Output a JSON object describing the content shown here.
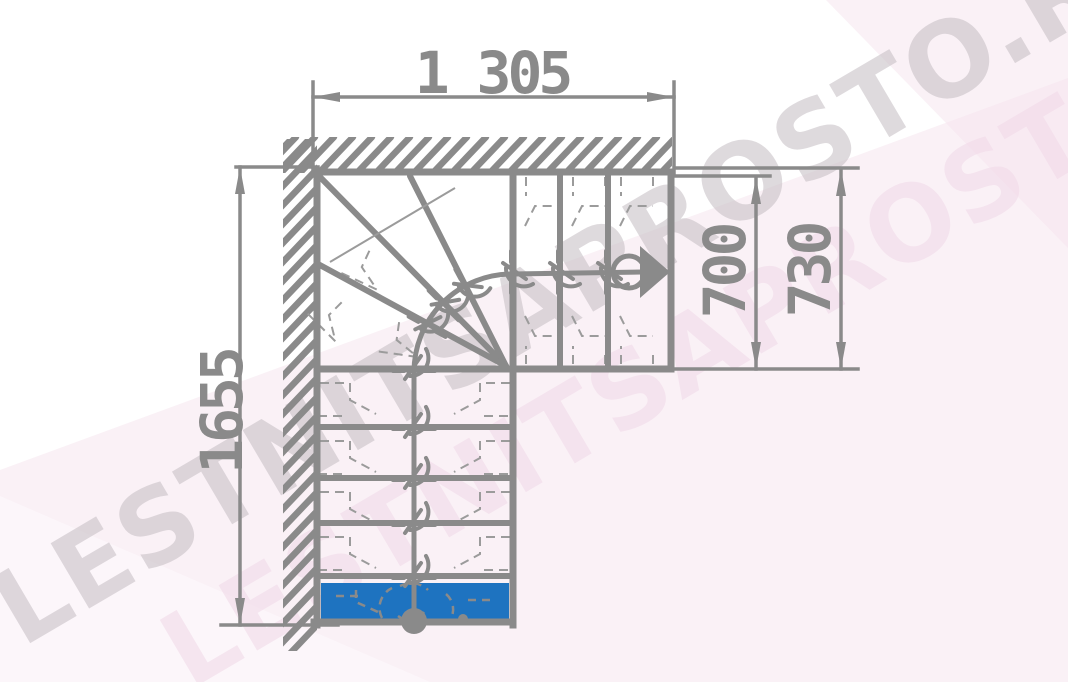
{
  "watermark": {
    "text": "LESTNITSAPROSTO.RU"
  },
  "dimensions": {
    "top_width": "1 305",
    "left_height": "1655",
    "right_inner": "700",
    "right_outer": "730"
  },
  "colors": {
    "background": "#ffffff",
    "line": "#8a8a8a",
    "dashed": "#9b9b9b",
    "first_step_fill": "#1e73c0",
    "watermark_gray": "#c9c2c7",
    "watermark_pink": "#f2dcea",
    "background_tint": "#f5e3ee"
  },
  "stair": {
    "outline": {
      "left": 317,
      "top": 172,
      "right": 671,
      "bottom": 622,
      "corner_x": 513,
      "corner_y": 369
    },
    "top_flight": {
      "risers_x": [
        560,
        608
      ],
      "walkline_y": 272
    },
    "lower_flight": {
      "walkline_x": 414,
      "tread_lines_y": [
        427,
        478,
        523,
        576
      ]
    },
    "winder": {
      "fan_center": [
        512,
        372
      ],
      "walkline_radius": 98,
      "fan_lines_to": [
        [
          320,
          177
        ],
        [
          410,
          176
        ],
        [
          318,
          264
        ]
      ],
      "dashed_motifs": [
        [
          366,
          258,
          25
        ],
        [
          336,
          308,
          45
        ],
        [
          398,
          330,
          8
        ]
      ]
    },
    "walk_marks": {
      "vertical_y": [
        369,
        427,
        478,
        523,
        576
      ],
      "horizontal_x": [
        513,
        560,
        608
      ],
      "winder": [
        [
          445,
          304,
          45
        ],
        [
          467,
          287,
          62
        ],
        [
          428,
          325,
          29
        ]
      ]
    },
    "first_step": {
      "x": 321,
      "y": 583,
      "width": 188,
      "height": 36
    }
  }
}
